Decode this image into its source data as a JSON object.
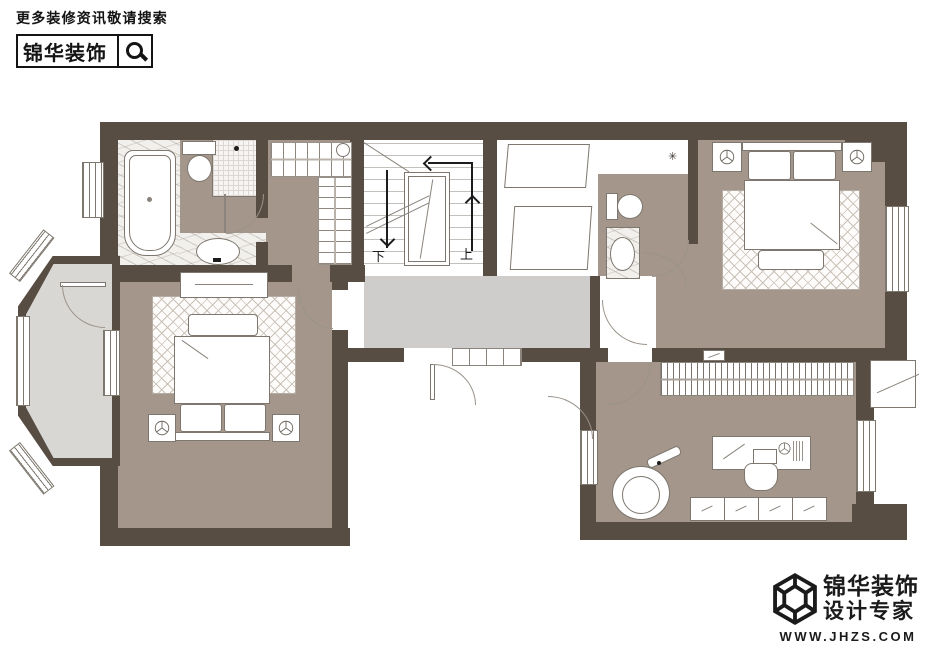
{
  "header": {
    "search_hint": "更多装修资讯敬请搜索",
    "brand": "锦华装饰",
    "icon": "magnifier-icon"
  },
  "footer": {
    "brand": "锦华装饰",
    "tagline": "设计专家",
    "website": "WWW.JHZS.COM",
    "icon": "cube-logo"
  },
  "plan": {
    "stairs": {
      "down_label": "下",
      "up_label": "上"
    },
    "icons": {
      "wall_lamp": "✳"
    },
    "colors": {
      "wall": "#584d43",
      "room_floor": "#a4968a",
      "hall_floor": "#cfcdcb",
      "balcony_floor": "#d9d7d4",
      "rug_line": "#c9c1b8",
      "outline": "#7e776e",
      "furniture_line": "#7d776f",
      "ink": "#1c1c1c"
    }
  }
}
